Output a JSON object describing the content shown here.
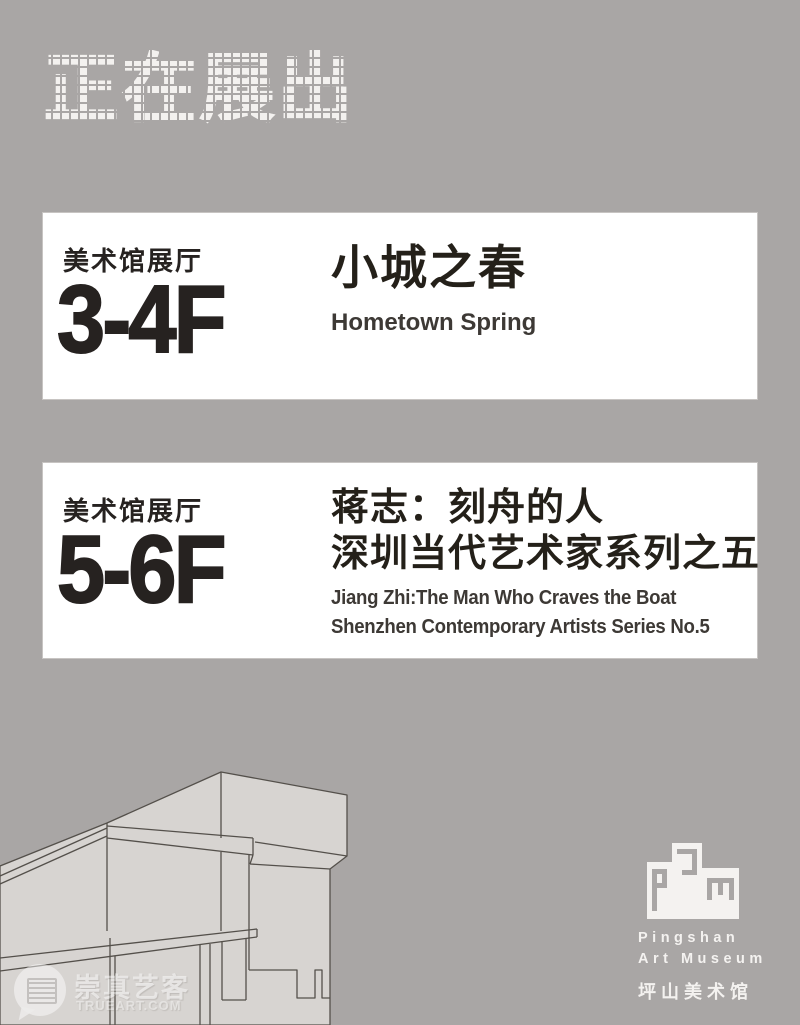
{
  "page": {
    "title": "正在展出",
    "bg_color": "#a9a6a5",
    "card_color": "#ffffff",
    "text_primary": "#262220",
    "text_secondary": "#3d3935",
    "building_fill": "#d7d4d1",
    "building_line": "#54504b"
  },
  "exhibitions": [
    {
      "venue": "美术馆展厅",
      "floor": "3-4F",
      "title_cn": [
        "小城之春"
      ],
      "title_en": [
        "Hometown Spring"
      ]
    },
    {
      "venue": "美术馆展厅",
      "floor": "5-6F",
      "title_cn": [
        "蒋志：刻舟的人",
        "深圳当代艺术家系列之五"
      ],
      "title_en": [
        "Jiang Zhi:The Man Who Craves the Boat",
        "Shenzhen Contemporary Artists Series No.5"
      ]
    }
  ],
  "footer": {
    "logo_name": "pam-logo",
    "museum_en_line1": "Pingshan",
    "museum_en_line2": "Art Museum",
    "museum_cn": "坪山美术馆"
  },
  "watermark": {
    "text": "崇真艺客",
    "subtext": "TRUEART.COM"
  }
}
